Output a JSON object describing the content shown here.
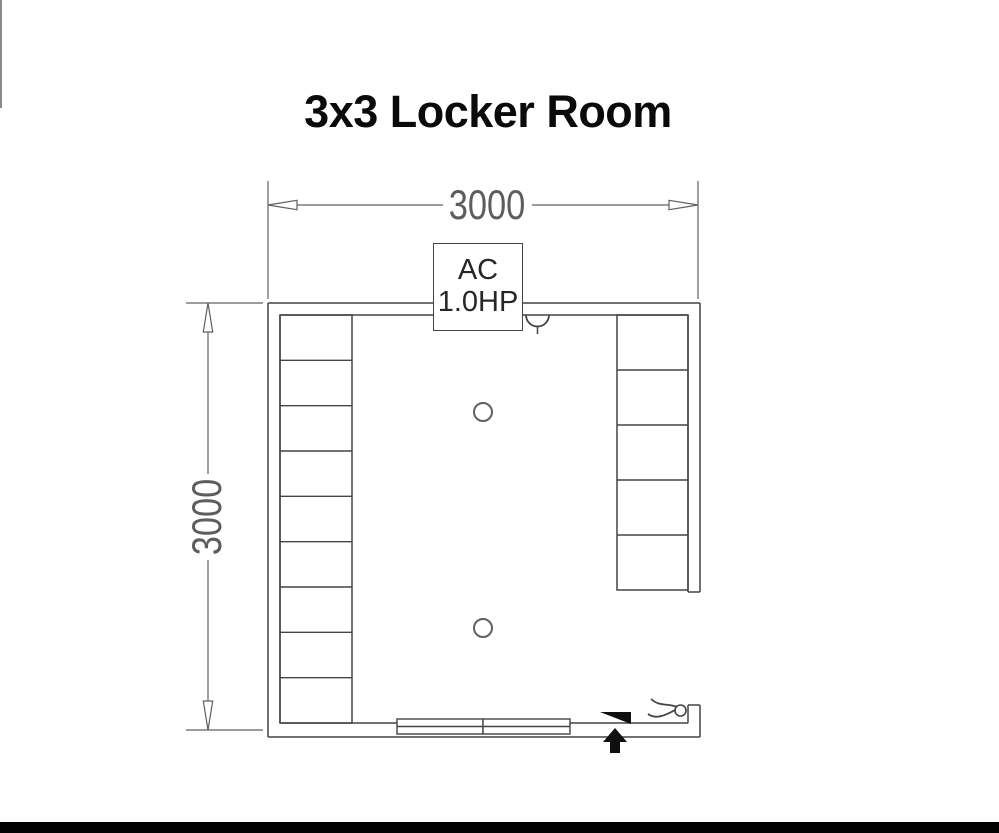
{
  "title": "3x3 Locker Room",
  "dimensions": {
    "width_label": "3000",
    "height_label": "3000"
  },
  "ac_unit": {
    "line1": "AC",
    "line2": "1.0HP"
  },
  "locker_banks": {
    "left": {
      "compartments": 9
    },
    "right": {
      "compartments": 5
    }
  },
  "symbols": {
    "ceiling_lights": 2,
    "entry_arrow": "up-arrow",
    "door_swing": "filled-triangle",
    "door_hardware": "curved-lines-with-circle",
    "wall_fixture": "semicircle-arc"
  },
  "colors": {
    "background": "#ffffff",
    "wall_line": "#444444",
    "dim_line": "#606060",
    "dim_text": "#5d5d5d",
    "title_text": "#0a0a0a",
    "ac_text": "#262626",
    "black_fill": "#0f0f0f",
    "footer_bar": "#020202",
    "edge_artifact": "#8a8a8a"
  }
}
